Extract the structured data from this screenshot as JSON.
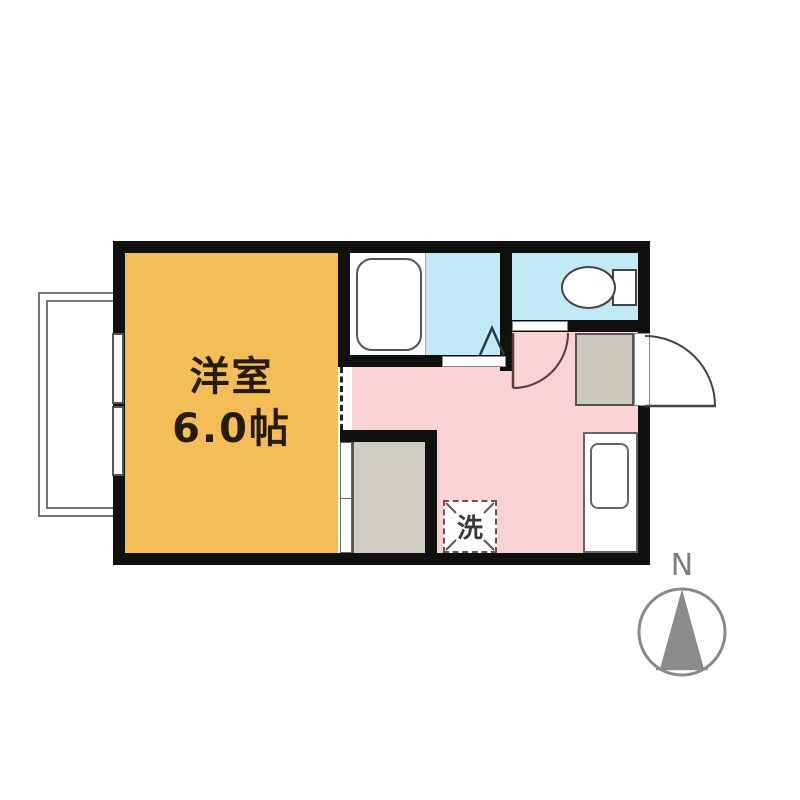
{
  "floor_plan": {
    "western_room": {
      "name_label": "洋室",
      "size_label": "6.0帖",
      "fill": "#F5BD58"
    },
    "dining_kitchen": {
      "fill": "#F9D3D3"
    },
    "bathroom": {
      "fill": "#C2EAF6"
    },
    "toilet_room": {
      "fill": "#C2EAF6"
    },
    "closet": {
      "fill": "#CFCBC0"
    },
    "entrance": {
      "fill": "#CCC8BB"
    },
    "washing_machine": {
      "label": "洗"
    },
    "compass": {
      "north_label": "N",
      "color": "#8A8A8A"
    },
    "wall_color": "#101010",
    "fixture_icons": [
      "bathtub-icon",
      "toilet-icon",
      "kitchen-sink-icon",
      "sliding-window-icon",
      "entrance-door-arc-icon",
      "toilet-door-arc-icon",
      "bath-folding-door-icon",
      "closet-sliding-door-icon",
      "balcony-icon",
      "compass-icon"
    ]
  }
}
